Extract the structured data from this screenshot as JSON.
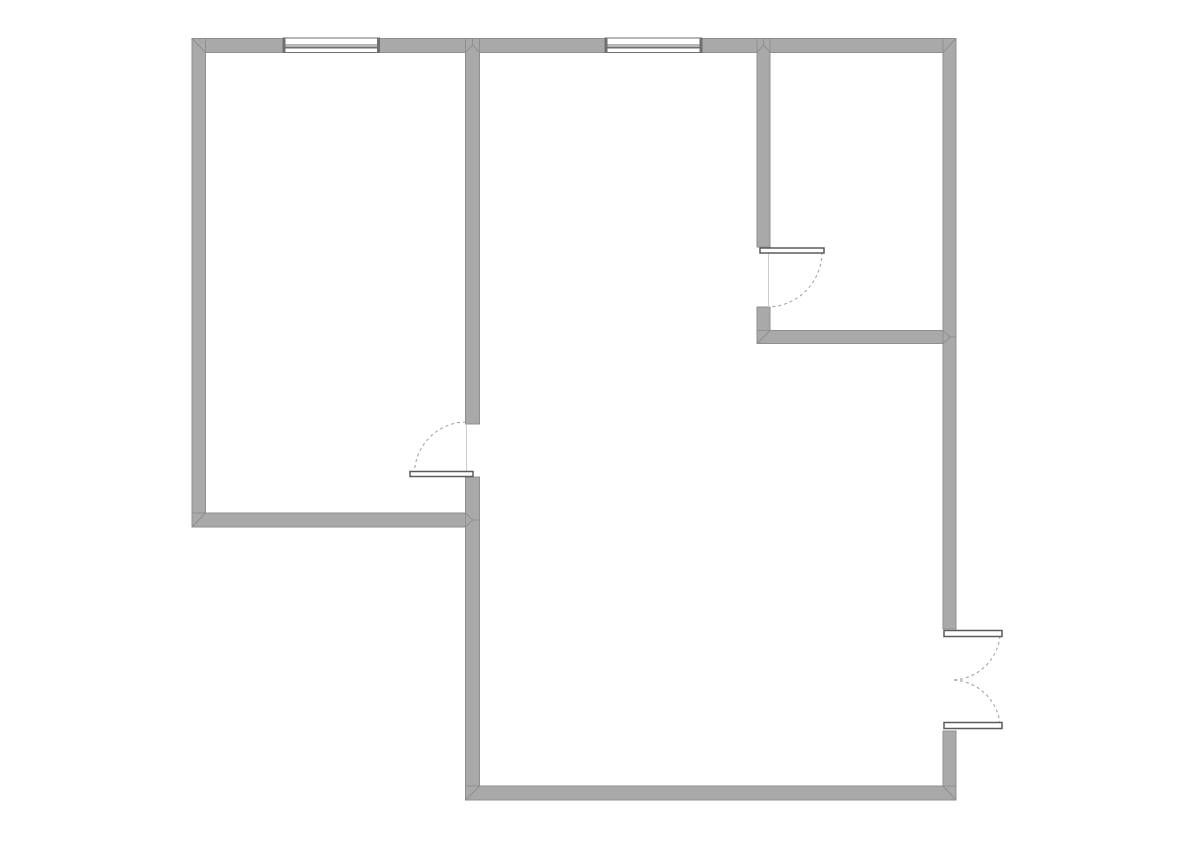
{
  "canvas": {
    "width": 1191,
    "height": 841,
    "background": "#ffffff"
  },
  "style": {
    "wall_fill": "#a9a9a9",
    "wall_edge": "#8f8f8f",
    "miter_line": "#8f8f8f",
    "window_fill": "#ffffff",
    "window_line": "#6f6f6f",
    "door_leaf_fill": "#ffffff",
    "door_leaf_edge": "#5a5a5a",
    "swing_arc": "#9e9e9e",
    "threshold_line": "#cccccc"
  },
  "walls": [
    {
      "name": "top-wall",
      "x": 192,
      "y": 38.5,
      "w": 764,
      "h": 14
    },
    {
      "name": "left-wall",
      "x": 192,
      "y": 38.5,
      "w": 13.5,
      "h": 488.5
    },
    {
      "name": "left-room-bottom-wall",
      "x": 192,
      "y": 513,
      "w": 287.5,
      "h": 14
    },
    {
      "name": "left-room-right-wall-upper",
      "x": 465.5,
      "y": 38.5,
      "w": 14,
      "h": 385.5
    },
    {
      "name": "left-room-right-wall-lower",
      "x": 465.5,
      "y": 477,
      "w": 14,
      "h": 323
    },
    {
      "name": "small-room-left-wall-upper",
      "x": 757,
      "y": 38.5,
      "w": 13,
      "h": 208.5
    },
    {
      "name": "small-room-left-wall-lower",
      "x": 757,
      "y": 307,
      "w": 13,
      "h": 36.5
    },
    {
      "name": "small-room-bottom-wall",
      "x": 757,
      "y": 330.5,
      "w": 199,
      "h": 13
    },
    {
      "name": "right-wall-upper",
      "x": 943,
      "y": 38.5,
      "w": 13,
      "h": 590.5
    },
    {
      "name": "right-wall-lower",
      "x": 943,
      "y": 731,
      "w": 13,
      "h": 69
    },
    {
      "name": "bottom-wall",
      "x": 465.5,
      "y": 786,
      "w": 490.5,
      "h": 14
    }
  ],
  "windows": [
    {
      "name": "window-top-left",
      "x": 283,
      "y": 38,
      "w": 96.5,
      "h": 14.5,
      "mullions": [
        45,
        47.5
      ],
      "cap_w": 2.5
    },
    {
      "name": "window-top-middle",
      "x": 605,
      "y": 38,
      "w": 97,
      "h": 14.5,
      "mullions": [
        45,
        47.5
      ],
      "cap_w": 2.5
    }
  ],
  "doors": [
    {
      "name": "small-room-door",
      "leaf": {
        "x": 760,
        "y": 248,
        "w": 64,
        "h": 5
      },
      "arc": "M 822 252 A 55 55 0 0 1 767 307",
      "threshold": {
        "x1": 768.5,
        "y1": 250,
        "x2": 768.5,
        "y2": 306
      }
    },
    {
      "name": "left-room-door",
      "leaf": {
        "x": 410,
        "y": 471.5,
        "w": 63,
        "h": 5
      },
      "arc": "M 414.5 474 A 52 52 0 0 1 466.5 422",
      "threshold": {
        "x1": 466.5,
        "y1": 424,
        "x2": 466.5,
        "y2": 471
      }
    },
    {
      "name": "entry-double-door-top-leaf",
      "leaf": {
        "x": 944,
        "y": 630.5,
        "w": 58,
        "h": 6
      },
      "arc": "M 1000 636 A 49 49 0 0 1 951 680"
    },
    {
      "name": "entry-double-door-bottom-leaf",
      "leaf": {
        "x": 944,
        "y": 722.5,
        "w": 58,
        "h": 6
      },
      "arc": "M 1000 724 A 49 49 0 0 0 951 680"
    }
  ],
  "miters": [
    {
      "name": "miter-top-left-corner",
      "x1": 192,
      "y1": 38.5,
      "x2": 205.5,
      "y2": 52.5
    },
    {
      "name": "miter-top-right-corner",
      "x1": 956,
      "y1": 38.5,
      "x2": 943,
      "y2": 52.5
    },
    {
      "name": "miter-top-t1-left",
      "x1": 465.5,
      "y1": 52.5,
      "x2": 472.5,
      "y2": 45
    },
    {
      "name": "miter-top-t1-right",
      "x1": 479.5,
      "y1": 52.5,
      "x2": 472.5,
      "y2": 45
    },
    {
      "name": "miter-top-t1-notch",
      "x1": 472.5,
      "y1": 38.5,
      "x2": 472.5,
      "y2": 45
    },
    {
      "name": "miter-top-t2-left",
      "x1": 757,
      "y1": 52.5,
      "x2": 763.5,
      "y2": 45
    },
    {
      "name": "miter-top-t2-right",
      "x1": 770,
      "y1": 52.5,
      "x2": 763.5,
      "y2": 45
    },
    {
      "name": "miter-top-t2-notch",
      "x1": 763.5,
      "y1": 38.5,
      "x2": 763.5,
      "y2": 45
    },
    {
      "name": "miter-left-room-bottom-left",
      "x1": 192,
      "y1": 527,
      "x2": 205.5,
      "y2": 513
    },
    {
      "name": "miter-left-room-bottom-t-upper",
      "x1": 465.5,
      "y1": 513,
      "x2": 472.5,
      "y2": 520
    },
    {
      "name": "miter-left-room-bottom-t-lower",
      "x1": 465.5,
      "y1": 527,
      "x2": 472.5,
      "y2": 520
    },
    {
      "name": "miter-left-room-bottom-t-notch",
      "x1": 472.5,
      "y1": 520,
      "x2": 479.5,
      "y2": 520
    },
    {
      "name": "miter-small-room-bottom-left",
      "x1": 757,
      "y1": 343.5,
      "x2": 770,
      "y2": 330.5
    },
    {
      "name": "miter-small-room-bottom-t-upper",
      "x1": 943,
      "y1": 330.5,
      "x2": 950,
      "y2": 337
    },
    {
      "name": "miter-small-room-bottom-t-lower",
      "x1": 943,
      "y1": 343.5,
      "x2": 950,
      "y2": 337
    },
    {
      "name": "miter-small-room-bottom-t-notch",
      "x1": 950,
      "y1": 337,
      "x2": 956,
      "y2": 337
    },
    {
      "name": "miter-bottom-left-corner",
      "x1": 465.5,
      "y1": 800,
      "x2": 479.5,
      "y2": 786
    },
    {
      "name": "miter-bottom-right-corner",
      "x1": 956,
      "y1": 800,
      "x2": 943,
      "y2": 786
    }
  ]
}
